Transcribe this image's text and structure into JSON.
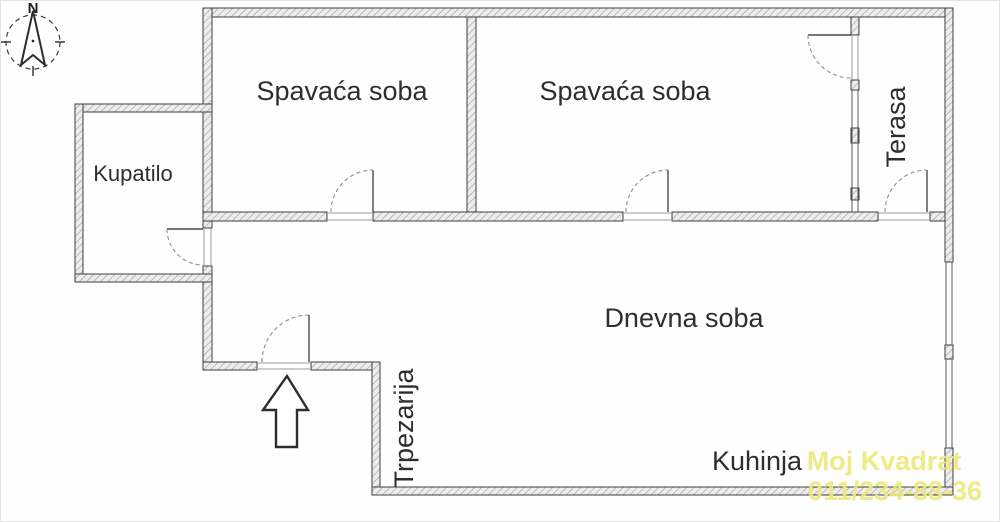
{
  "compass": {
    "north": "N"
  },
  "rooms": {
    "bedroom1": "Spavaća soba",
    "bedroom2": "Spavaća soba",
    "bathroom": "Kupatilo",
    "terrace": "Terasa",
    "living_room": "Dnevna soba",
    "dining_room": "Trpezarija",
    "kitchen": "Kuhinja"
  },
  "watermark": {
    "brand": "Moj Kvadrat",
    "phone": "011/234-88-36",
    "color": "#efe97a"
  },
  "colors": {
    "wall_fill": "#ededed",
    "wall_hatch": "#9b9b9b",
    "wall_outline": "#3f3f3f",
    "background": "#fefefe"
  }
}
